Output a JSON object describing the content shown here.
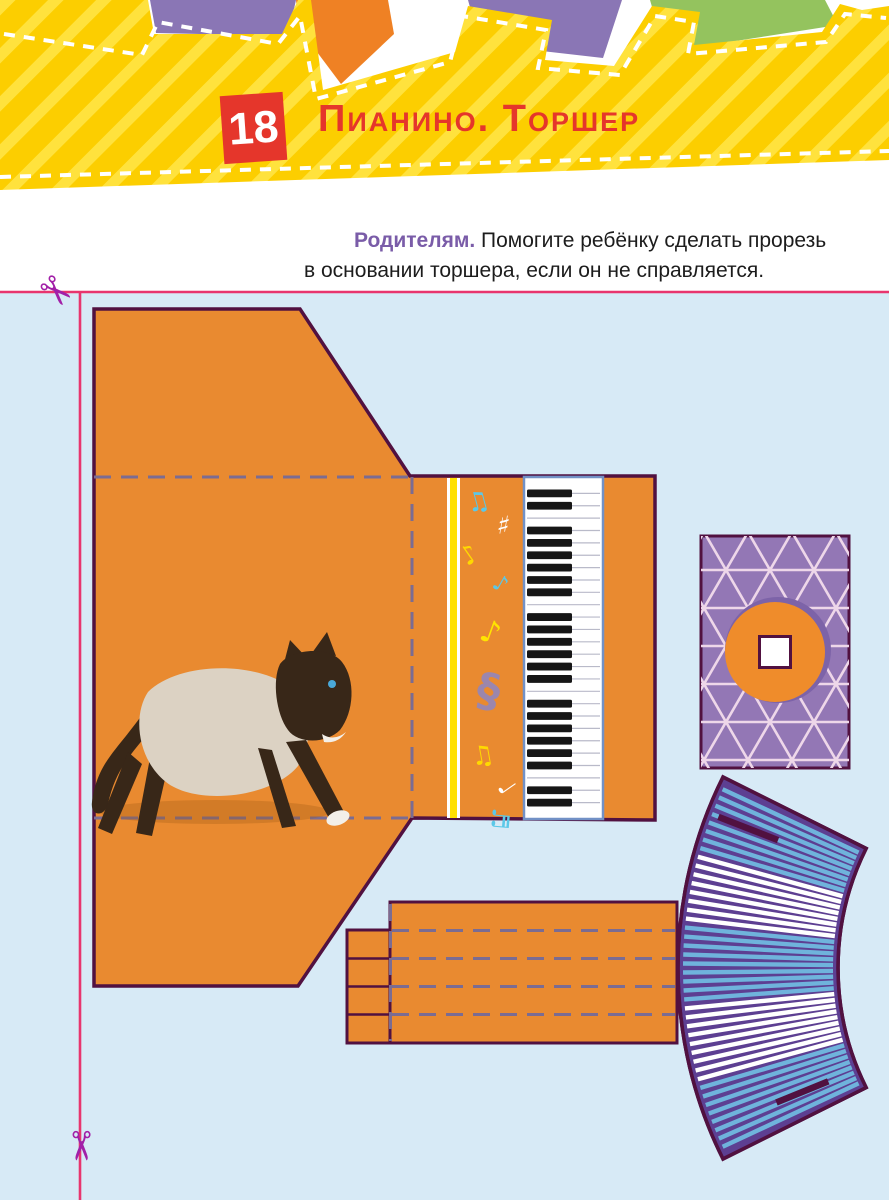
{
  "header": {
    "badge": "18",
    "title": "Пианино. Торшер"
  },
  "note": {
    "lead": "Родителям.",
    "line1": " Помогите ребёнку сделать прорезь",
    "line2": "в основании торшера, если он не справляется."
  },
  "scissors": {
    "top": "✂",
    "bottom": "✂"
  },
  "palette": {
    "header_yellow": "#fcce00",
    "header_stripe": "#ffe23d",
    "shape_purple": "#8a76b5",
    "shape_orange": "#ef8124",
    "shape_green": "#94c35e",
    "accent_red": "#e5362b",
    "note_purple": "#7a5ca8",
    "ink": "#1c1c1c",
    "area_blue": "#d7eaf6",
    "cut_pink": "#e8356e",
    "scissors": "#a220a8",
    "piece_orange": "#e98a30",
    "outline": "#511140",
    "fold": "#7b6c92",
    "stripe_yellow": "#ffe000",
    "key_border": "#7291c6",
    "base_purple": "#9377b5",
    "base_pattern": "#eed7e9",
    "base_shadow": "#7d63a8",
    "circle_orange": "#ef8c2b",
    "shade_purple": "#5d3f92",
    "shade_blue": "#6fb3dc",
    "shade_white": "#ffffff",
    "cat_body": "#dcd2c3",
    "cat_dark": "#382718"
  },
  "craft": {
    "piano": {
      "keyboard": {
        "x": 527,
        "y": 481,
        "width": 73,
        "height": 334,
        "white_keys": 27,
        "black_pattern": [
          0,
          1,
          3,
          4,
          5,
          6
        ],
        "black_width": 45,
        "black_height": 7.8
      },
      "notes": [
        {
          "glyph": "♫",
          "color": "#5bc8e8",
          "x": 480,
          "y": 510,
          "size": 26,
          "rotate": -15
        },
        {
          "glyph": "♯",
          "color": "#ffffff",
          "x": 502,
          "y": 534,
          "size": 26,
          "rotate": 10
        },
        {
          "glyph": "♪",
          "color": "#ffd900",
          "x": 474,
          "y": 562,
          "size": 26,
          "rotate": -35
        },
        {
          "glyph": "♪",
          "color": "#5bc8e8",
          "x": 497,
          "y": 590,
          "size": 22,
          "rotate": 30
        },
        {
          "glyph": "♪",
          "color": "#ffe400",
          "x": 487,
          "y": 642,
          "size": 31,
          "rotate": 20
        },
        {
          "glyph": "§",
          "color": "#9b86ad",
          "x": 486,
          "y": 706,
          "size": 46,
          "rotate": 10
        },
        {
          "glyph": "♫",
          "color": "#ffd900",
          "x": 484,
          "y": 764,
          "size": 26,
          "rotate": -10
        },
        {
          "glyph": "♩",
          "color": "#ffffff",
          "x": 500,
          "y": 792,
          "size": 24,
          "rotate": 55
        },
        {
          "glyph": "♬",
          "color": "#5bc8e8",
          "x": 492,
          "y": 818,
          "size": 24,
          "rotate": 95
        }
      ]
    },
    "lampshade": {
      "cx": 1106,
      "cy": 968,
      "r_inner": 268,
      "r_outer": 428,
      "a_start": 153.5,
      "a_end": 206.5,
      "stripe_thickness": 4.4,
      "stripe_margin_deg": 1.5,
      "sections": [
        {
          "count": 8,
          "color": "shade_blue"
        },
        {
          "count": 8,
          "color": "shade_white"
        },
        {
          "count": 9,
          "color": "shade_blue"
        },
        {
          "count": 9,
          "color": "shade_white"
        },
        {
          "count": 8,
          "color": "shade_blue"
        }
      ],
      "slits": [
        {
          "angle": 201.3,
          "r1": 352,
          "r2": 416
        },
        {
          "angle": 157.8,
          "r1": 300,
          "r2": 356
        }
      ]
    }
  }
}
